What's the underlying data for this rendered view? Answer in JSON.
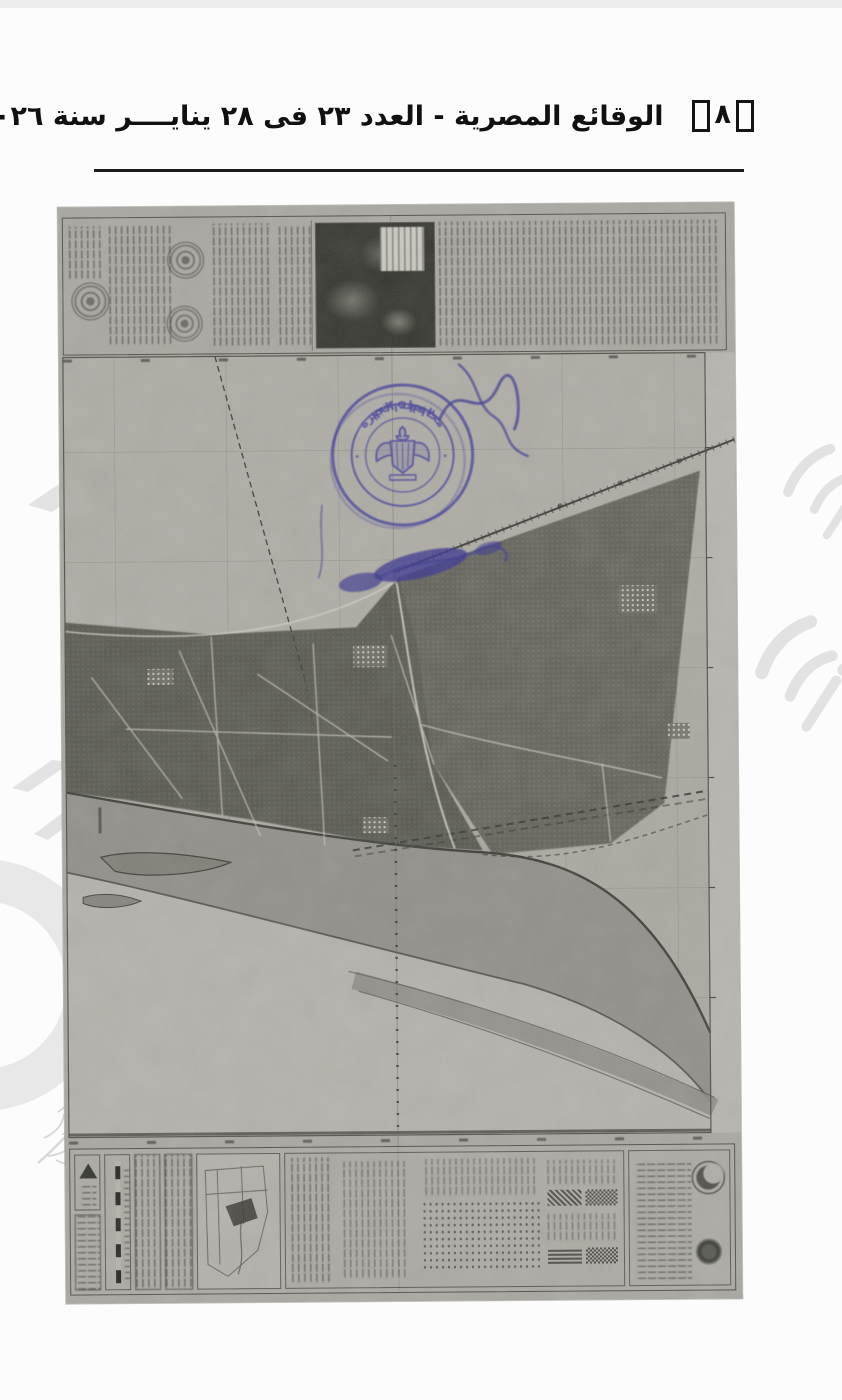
{
  "page": {
    "header": {
      "page_number": "٨",
      "title": "الوقائع المصرية - العدد ٢٣ فى ٢٨ ينايــــر سنة ٢٠٢٦"
    }
  },
  "stamp": {
    "arc_top": "محافظة الجيزة",
    "arc_bottom": "الديوان العام",
    "ink_color": "#3f3b99"
  },
  "colors": {
    "scan_paper": "#a8a69f",
    "dark_farmland": "#52524b",
    "river_light": "#b3b1aa",
    "rule_line": "#1b1b1b",
    "watermark_gray": "#e3e3e3"
  }
}
